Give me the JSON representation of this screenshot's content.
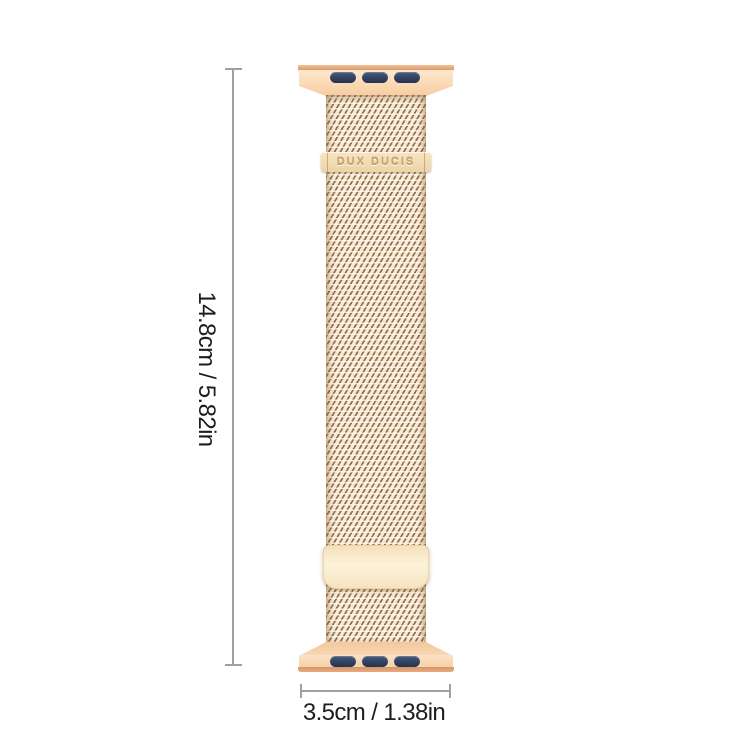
{
  "page": {
    "background": "#ffffff"
  },
  "product": {
    "kind": "milanese-loop-watch-band",
    "brand_text": "DUX DUCIS",
    "colors": {
      "band_base": "#f5ebd3",
      "band_weave": "#8a6040",
      "connector_light": "#f9d8b2",
      "connector_edge": "#d6946a",
      "slot_navy": "#24304e",
      "clasp_plate": "#fcf2d8",
      "brand_bar": "#ecd3a8"
    }
  },
  "dimensions": {
    "height_label": "14.8cm / 5.82in",
    "width_label": "3.5cm / 1.38in",
    "line_color": "#a0a0a0",
    "text_color": "#1e1e1e"
  }
}
